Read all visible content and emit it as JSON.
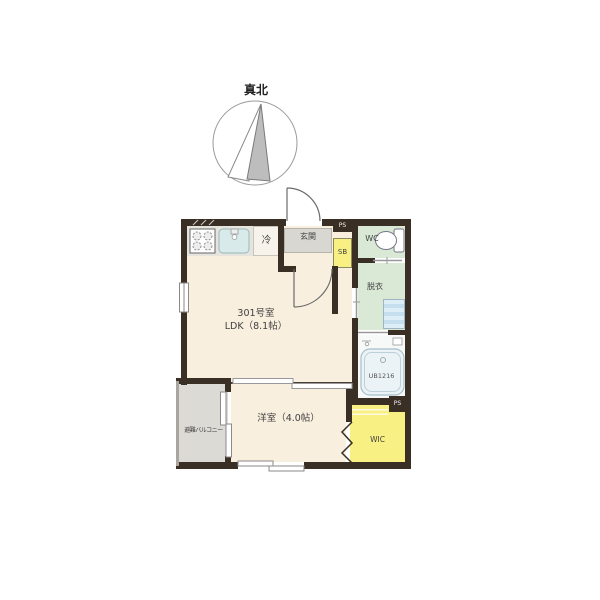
{
  "compass": {
    "label": "真北"
  },
  "unit": {
    "room_number": "301号室",
    "ldk_label": "LDK（8.1帖）",
    "bedroom_label": "洋室（4.0帖）",
    "entrance_label": "玄関",
    "wc_label": "WC",
    "dressing_room_label": "脱衣",
    "bath_label": "UB1216",
    "wic_label": "WIC",
    "balcony_label": "避難バルコニー",
    "refrigerator_label": "冷",
    "shoe_box_label": "SB",
    "pipe_space_top_label": "PS",
    "pipe_space_bottom_label": "PS"
  },
  "colors": {
    "wall": "#3a2f25",
    "floor": "#f9efdf",
    "tile": "#d9d7d2",
    "wet": "#d9e9d6",
    "storage": "#f8f083",
    "counter": "#e6e4de",
    "balcony": "#dcdad5",
    "bath": "#f7f9f8",
    "text": "#3f3f3f"
  }
}
